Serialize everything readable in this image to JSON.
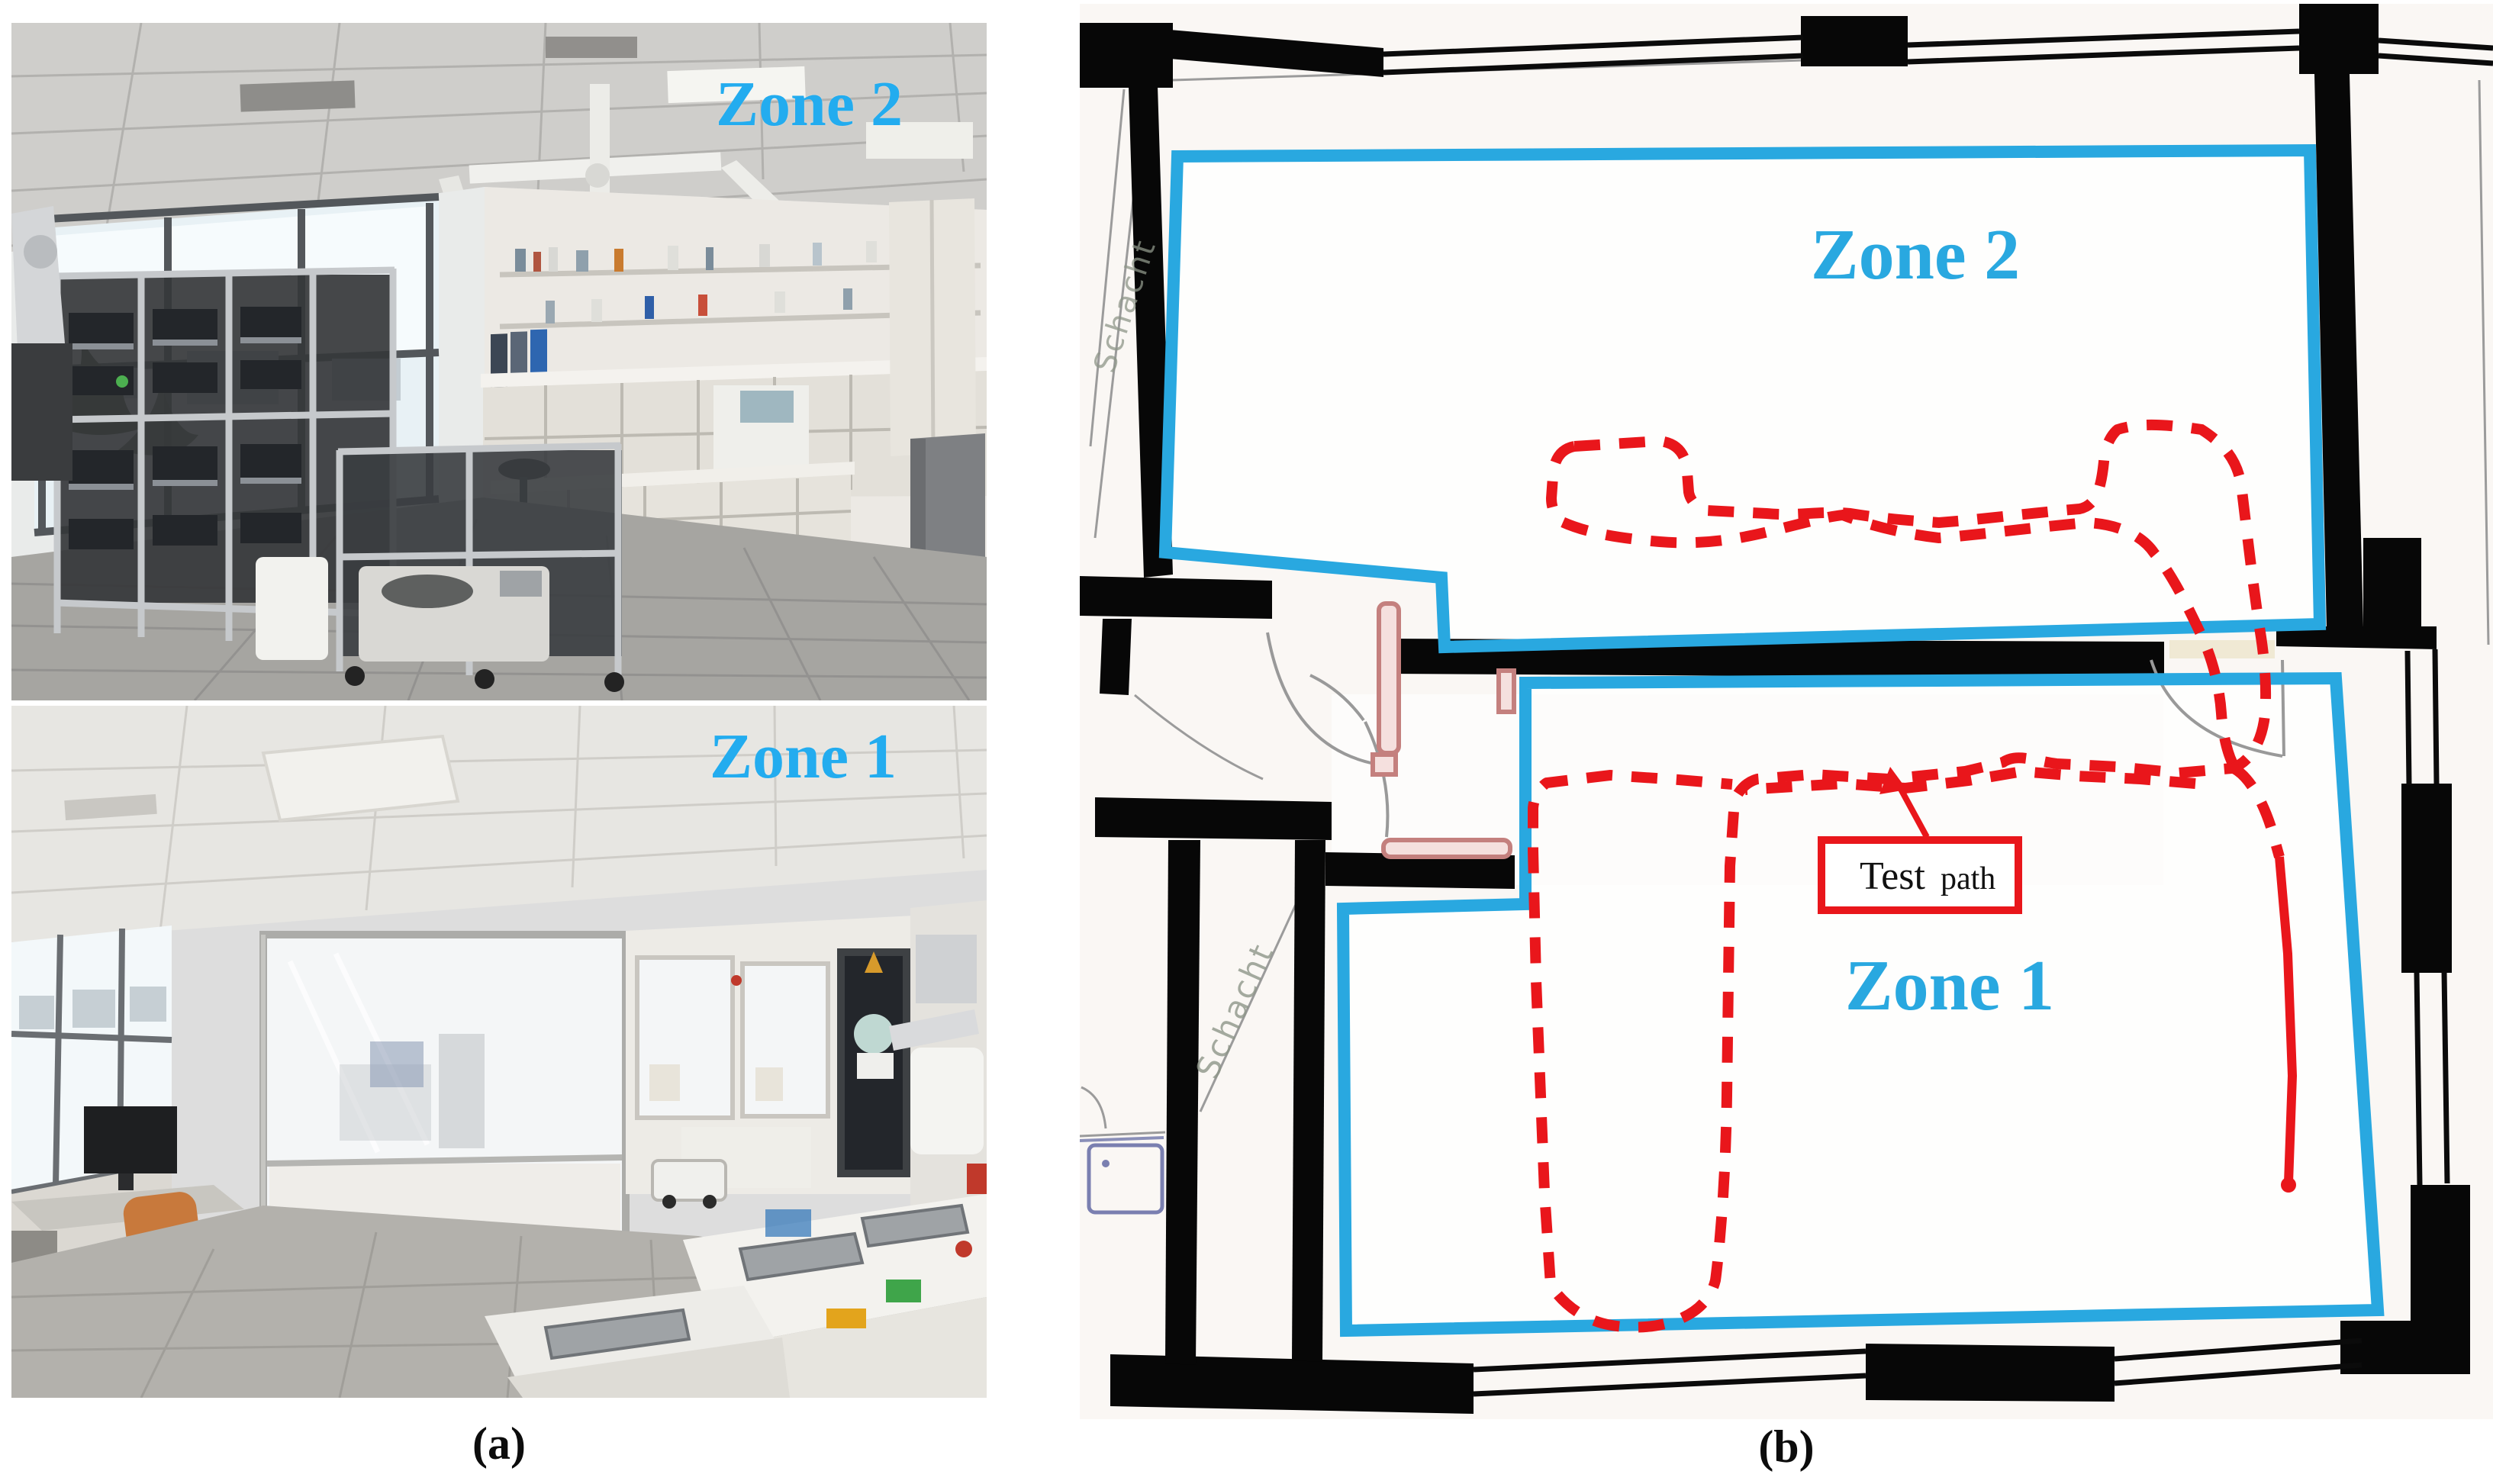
{
  "figure": {
    "caption_a": "(a)",
    "caption_b": "(b)",
    "photos": {
      "top_label": "Zone 2",
      "bottom_label": "Zone 1"
    },
    "plan": {
      "zone2_label": "Zone 2",
      "zone1_label": "Zone 1",
      "test_path_word1": "Test",
      "test_path_word2": "path",
      "schacht_upper": "Schacht",
      "schacht_lower": "Schacht"
    },
    "colors": {
      "zone_outline": "#29A8E0",
      "zone_label": "#23ACEF",
      "path_red": "#E9161B",
      "wall_black": "#070707",
      "door_pink": "#C4807E",
      "plan_background": "#FAF7F4"
    }
  }
}
